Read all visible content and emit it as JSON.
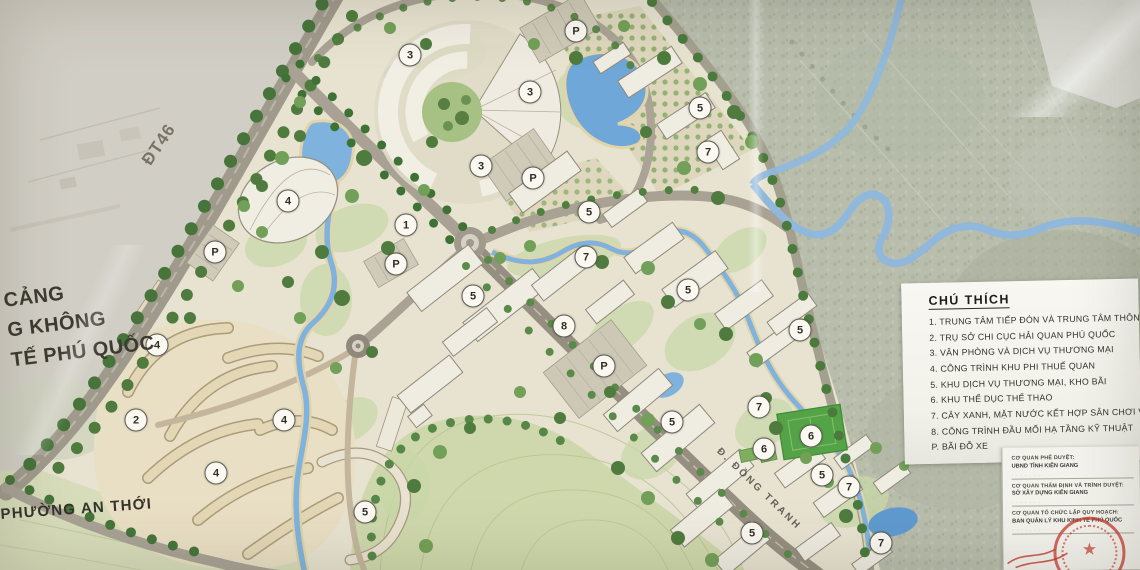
{
  "map": {
    "labels": {
      "route_dt46": "ĐT46",
      "road_dong_tranh": "Đ. ĐỒNG TRANH",
      "ward": "PHƯỜNG AN THỚI",
      "airport_lines": [
        "CẢNG",
        "G KHÔNG",
        "TẾ PHÚ QUỐC"
      ]
    },
    "markers": [
      {
        "label": "1",
        "x": 406,
        "y": 225
      },
      {
        "label": "2",
        "x": 136,
        "y": 420
      },
      {
        "label": "3",
        "x": 410,
        "y": 55
      },
      {
        "label": "3",
        "x": 530,
        "y": 92
      },
      {
        "label": "3",
        "x": 481,
        "y": 166
      },
      {
        "label": "4",
        "x": 288,
        "y": 201
      },
      {
        "label": "4",
        "x": 157,
        "y": 345
      },
      {
        "label": "4",
        "x": 284,
        "y": 420
      },
      {
        "label": "4",
        "x": 216,
        "y": 473
      },
      {
        "label": "5",
        "x": 700,
        "y": 108
      },
      {
        "label": "5",
        "x": 589,
        "y": 212
      },
      {
        "label": "5",
        "x": 473,
        "y": 296
      },
      {
        "label": "5",
        "x": 688,
        "y": 290
      },
      {
        "label": "5",
        "x": 800,
        "y": 330
      },
      {
        "label": "5",
        "x": 672,
        "y": 422
      },
      {
        "label": "5",
        "x": 822,
        "y": 475
      },
      {
        "label": "5",
        "x": 752,
        "y": 533
      },
      {
        "label": "5",
        "x": 365,
        "y": 512
      },
      {
        "label": "6",
        "x": 811,
        "y": 436
      },
      {
        "label": "6",
        "x": 764,
        "y": 449
      },
      {
        "label": "7",
        "x": 708,
        "y": 152
      },
      {
        "label": "7",
        "x": 586,
        "y": 257
      },
      {
        "label": "7",
        "x": 759,
        "y": 407
      },
      {
        "label": "7",
        "x": 849,
        "y": 487
      },
      {
        "label": "7",
        "x": 881,
        "y": 543
      },
      {
        "label": "8",
        "x": 564,
        "y": 326
      },
      {
        "label": "P",
        "x": 576,
        "y": 31
      },
      {
        "label": "P",
        "x": 533,
        "y": 178
      },
      {
        "label": "P",
        "x": 215,
        "y": 252
      },
      {
        "label": "P",
        "x": 396,
        "y": 264
      },
      {
        "label": "P",
        "x": 604,
        "y": 366
      }
    ]
  },
  "legend": {
    "title": "CHÚ THÍCH",
    "items": [
      "1. TRUNG TÂM TIẾP ĐÓN VÀ TRUNG TÂM THÔNG TIN",
      "2. TRỤ SỞ CHI CỤC HẢI QUAN PHÚ QUỐC",
      "3. VĂN PHÒNG VÀ DỊCH VỤ THƯƠNG MẠI",
      "4. CÔNG TRÌNH KHU PHI THUẾ QUAN",
      "5. KHU DỊCH VỤ THƯƠNG MẠI, KHO BÃI",
      "6. KHU THỂ DỤC THỂ THAO",
      "7. CÂY XANH, MẶT NƯỚC KẾT HỢP SÂN CHƠI VÀ ĐƯỜNG",
      "8. CÔNG TRÌNH ĐẦU MỐI HẠ TẦNG KỸ THUẬT",
      "P. BÃI ĐỖ XE"
    ]
  },
  "title_block": {
    "rows": [
      {
        "label": "CƠ QUAN PHÊ DUYỆT:",
        "value": "UBND TỈNH KIÊN GIANG"
      },
      {
        "label": "CƠ QUAN THẨM ĐỊNH VÀ TRÌNH DUYỆT:",
        "value": "SỞ XÂY DỰNG KIÊN GIANG"
      },
      {
        "label": "CƠ QUAN TỔ CHỨC LẬP QUY HOẠCH:",
        "value": "BAN QUẢN LÝ KHU KINH TẾ PHÚ QUỐC"
      }
    ]
  },
  "colors": {
    "water": "#7fb3dd",
    "road": "#a09a8d",
    "tree_dark": "#46743a",
    "plan_base": "#e8e3d1",
    "aerial_photo": "#b8bdac",
    "paper": "#f6f5f0",
    "stamp_red": "#c0392b"
  }
}
